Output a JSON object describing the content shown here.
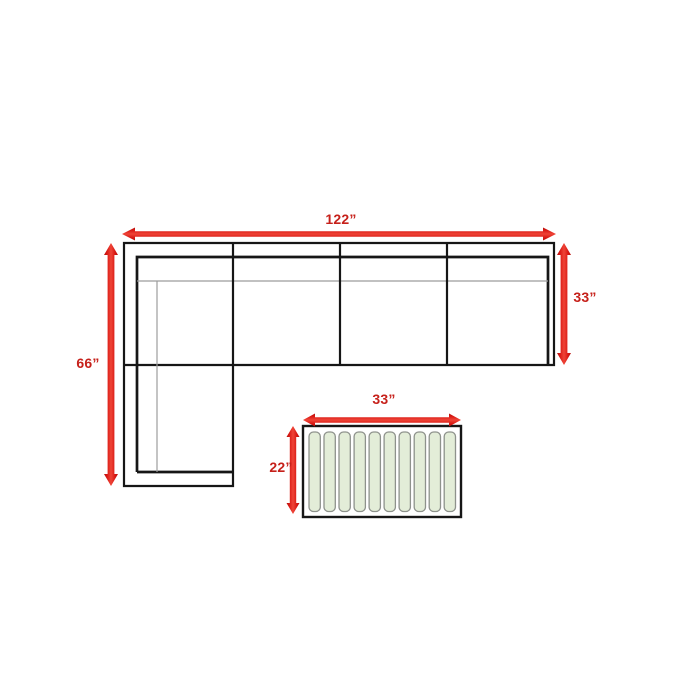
{
  "colors": {
    "background": "#ffffff",
    "arrow_red": "#D81712",
    "arrow_red_dark": "#B2110D",
    "arrow_red_light": "#EF4437",
    "dimension_text_red": "#C6201A",
    "furniture_outline": "#161616",
    "cushion_line_gray": "#9C9C9C",
    "slat_fill": "#E3EDD8",
    "slat_border": "#8E928C"
  },
  "sectional_sofa": {
    "description": "L-shaped sectional sofa, top view, four seat sections with left chaise",
    "overall_width_label": "122”",
    "depth_label": "33”",
    "chaise_length_label": "66”",
    "seat_section_count": 4
  },
  "coffee_table": {
    "description": "Slatted rectangular coffee table, top view",
    "width_label": "33”",
    "depth_label": "22”",
    "slat_count": 10
  }
}
